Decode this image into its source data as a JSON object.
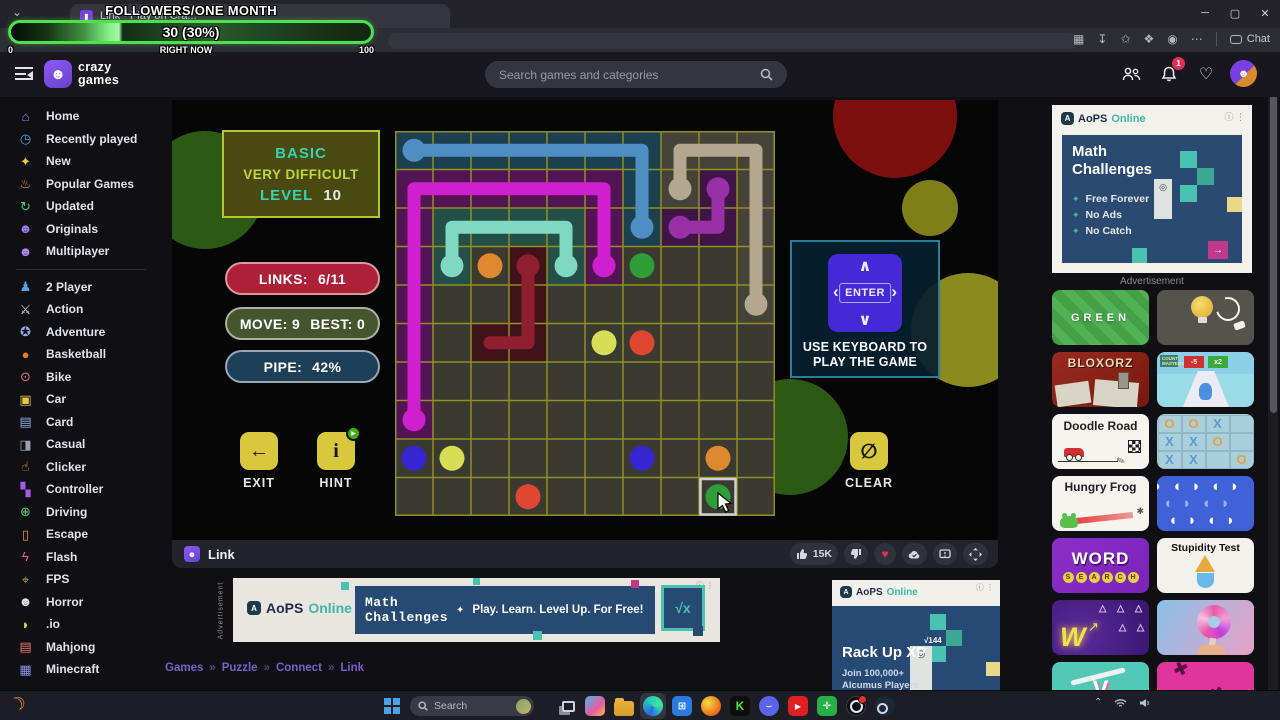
{
  "overlay": {
    "title": "FOLLOWERS/ONE MONTH",
    "value_label": "30 (30%)",
    "min_label": "0",
    "now_label": "RIGHT NOW",
    "max_label": "100",
    "percent": 30
  },
  "browser": {
    "tab_title": "Link · Play on Cra...",
    "chat_label": "Chat"
  },
  "header": {
    "wordmark1": "crazy",
    "wordmark2": "games",
    "search_placeholder": "Search games and categories",
    "notification_count": "1"
  },
  "sidebar": {
    "items": [
      {
        "label": "Home",
        "icon": "home-icon",
        "glyph": "⌂",
        "color": "#9b7bf0"
      },
      {
        "label": "Recently played",
        "icon": "clock-icon",
        "glyph": "◷",
        "color": "#5aa2e8"
      },
      {
        "label": "New",
        "icon": "sparkles-icon",
        "glyph": "✦",
        "color": "#e8c84a"
      },
      {
        "label": "Popular Games",
        "icon": "flame-icon",
        "glyph": "♨",
        "color": "#f08a3c"
      },
      {
        "label": "Updated",
        "icon": "refresh-icon",
        "glyph": "↻",
        "color": "#57c96b"
      },
      {
        "label": "Originals",
        "icon": "ghost-icon",
        "glyph": "☻",
        "color": "#9b7bf0"
      },
      {
        "label": "Multiplayer",
        "icon": "people-icon",
        "glyph": "☻",
        "color": "#b58af0",
        "divider_after": true
      },
      {
        "label": "2 Player",
        "icon": "two-player-icon",
        "glyph": "♟",
        "color": "#5aa2e8"
      },
      {
        "label": "Action",
        "icon": "sword-icon",
        "glyph": "⚔",
        "color": "#d8d8e0"
      },
      {
        "label": "Adventure",
        "icon": "compass-icon",
        "glyph": "✪",
        "color": "#9aa8e8"
      },
      {
        "label": "Basketball",
        "icon": "basketball-icon",
        "glyph": "●",
        "color": "#e8782c"
      },
      {
        "label": "Bike",
        "icon": "bike-icon",
        "glyph": "⊙",
        "color": "#e86a8a"
      },
      {
        "label": "Car",
        "icon": "car-icon",
        "glyph": "▣",
        "color": "#e8c84a"
      },
      {
        "label": "Card",
        "icon": "card-icon",
        "glyph": "▤",
        "color": "#8ab4e8"
      },
      {
        "label": "Casual",
        "icon": "joystick-icon",
        "glyph": "◨",
        "color": "#9aa0b0"
      },
      {
        "label": "Clicker",
        "icon": "pointer-icon",
        "glyph": "☝",
        "color": "#e8a83c"
      },
      {
        "label": "Controller",
        "icon": "gamepad-icon",
        "glyph": "▚",
        "color": "#a85ae8"
      },
      {
        "label": "Driving",
        "icon": "steering-wheel-icon",
        "glyph": "⊕",
        "color": "#57c96b"
      },
      {
        "label": "Escape",
        "icon": "door-icon",
        "glyph": "▯",
        "color": "#e8953c"
      },
      {
        "label": "Flash",
        "icon": "lightning-icon",
        "glyph": "ϟ",
        "color": "#e85aa0"
      },
      {
        "label": "FPS",
        "icon": "crosshair-icon",
        "glyph": "⌖",
        "color": "#c9a05a"
      },
      {
        "label": "Horror",
        "icon": "ghost-icon",
        "glyph": "☻",
        "color": "#e8e8f0"
      },
      {
        "label": ".io",
        "icon": "pacman-icon",
        "glyph": "◗",
        "color": "#e8d84a"
      },
      {
        "label": "Mahjong",
        "icon": "tile-icon",
        "glyph": "▤",
        "color": "#e87a6a"
      },
      {
        "label": "Minecraft",
        "icon": "block-icon",
        "glyph": "▦",
        "color": "#8a94e8"
      }
    ]
  },
  "game": {
    "level_box": {
      "line1": "BASIC",
      "line2": "VERY DIFFICULT",
      "level_label": "LEVEL",
      "level_value": "10"
    },
    "stats": {
      "links_label": "LINKS:",
      "links_value": "6/11",
      "move_label": "MOVE: 9",
      "best_label": "BEST: 0",
      "pipe_label": "PIPE:",
      "pipe_value": "42%"
    },
    "buttons": {
      "exit": "EXIT",
      "hint": "HINT",
      "clear": "CLEAR"
    },
    "keyboard": {
      "key_label": "ENTER",
      "caption1": "USE KEYBOARD TO",
      "caption2": "PLAY THE GAME"
    },
    "grid": {
      "cols": 10,
      "rows": 10,
      "line_color": "#8f8f22",
      "cell_bg": "#3a3a31",
      "pipes": [
        {
          "name": "blue",
          "color": "#4e8ec2",
          "tint": "#1d4050",
          "path": [
            [
              0,
              0
            ],
            [
              6,
              0
            ],
            [
              6,
              2
            ]
          ],
          "endpoints": [
            [
              0,
              0
            ],
            [
              6,
              2
            ]
          ]
        },
        {
          "name": "tan",
          "color": "#b3a88f",
          "tint": "#45423a",
          "path": [
            [
              7,
              1
            ],
            [
              7,
              0
            ],
            [
              9,
              0
            ],
            [
              9,
              4
            ]
          ],
          "endpoints": [
            [
              7,
              1
            ],
            [
              9,
              4
            ]
          ]
        },
        {
          "name": "magenta",
          "color": "#cf1fcf",
          "tint": "#521452",
          "path": [
            [
              5,
              3
            ],
            [
              5,
              1
            ],
            [
              0,
              1
            ],
            [
              0,
              7
            ]
          ],
          "endpoints": [
            [
              5,
              3
            ],
            [
              0,
              7
            ]
          ]
        },
        {
          "name": "teal",
          "color": "#7fd8c0",
          "tint": "#234f46",
          "path": [
            [
              1,
              3
            ],
            [
              1,
              2
            ],
            [
              4,
              2
            ],
            [
              4,
              3
            ]
          ],
          "endpoints": [
            [
              1,
              3
            ],
            [
              4,
              3
            ]
          ]
        },
        {
          "name": "purple",
          "color": "#9a30a8",
          "tint": "#3f1545",
          "path": [
            [
              8,
              1
            ],
            [
              8,
              2
            ],
            [
              7,
              2
            ]
          ],
          "endpoints": [
            [
              8,
              1
            ],
            [
              7,
              2
            ]
          ]
        },
        {
          "name": "dark-red",
          "color": "#8f1f2f",
          "tint": "#401219",
          "path": [
            [
              3,
              3
            ],
            [
              3,
              5
            ],
            [
              2,
              5
            ]
          ],
          "endpoints": [
            [
              3,
              3
            ]
          ]
        }
      ],
      "dots": [
        {
          "color": "#de8830",
          "cell": [
            2,
            3
          ]
        },
        {
          "color": "#2f9e38",
          "cell": [
            6,
            3
          ]
        },
        {
          "color": "#d6de55",
          "cell": [
            5,
            5
          ]
        },
        {
          "color": "#de4830",
          "cell": [
            6,
            5
          ]
        },
        {
          "color": "#3526cf",
          "cell": [
            0,
            8
          ]
        },
        {
          "color": "#d6de55",
          "cell": [
            1,
            8
          ]
        },
        {
          "color": "#3526cf",
          "cell": [
            6,
            8
          ]
        },
        {
          "color": "#de8830",
          "cell": [
            8,
            8
          ]
        },
        {
          "color": "#de4830",
          "cell": [
            3,
            9
          ]
        },
        {
          "color": "#2f9e38",
          "cell": [
            8,
            9
          ]
        }
      ],
      "selected_cell": [
        8,
        9
      ]
    }
  },
  "player_bar": {
    "title": "Link",
    "likes": "15K"
  },
  "ads": {
    "top_right": {
      "brand_a": "AoPS",
      "brand_b": "Online",
      "heading1": "Math",
      "heading2": "Challenges",
      "bullets": [
        "Free Forever",
        "No Ads",
        "No Catch"
      ],
      "caption": "Advertisement"
    },
    "banner": {
      "side_label": "Advertisement",
      "brand_a": "AoPS",
      "brand_b": "Online",
      "heading1": "Math",
      "heading2": "Challenges",
      "tagline": "Play. Learn. Level Up. For Free!",
      "formula": "√x"
    },
    "bottom_right": {
      "brand_a": "AoPS",
      "brand_b": "Online",
      "heading": "Rack Up XP",
      "sub1": "Join 100,000+",
      "sub2": "Alcumus Players",
      "formula": "√144"
    }
  },
  "thumbnails": [
    {
      "kind": "green",
      "name": "thumb-green",
      "title": "GREEN"
    },
    {
      "kind": "bulb",
      "name": "thumb-bulb-plug"
    },
    {
      "kind": "blox",
      "name": "thumb-bloxorz",
      "title": "BLOXORZ"
    },
    {
      "kind": "count",
      "name": "thumb-count-runner",
      "badge_left": "-5",
      "badge_right": "x2",
      "flag": "COUNT MASTERS"
    },
    {
      "kind": "doodle",
      "name": "thumb-doodle-road",
      "title": "Doodle Road"
    },
    {
      "kind": "ttt",
      "name": "thumb-tic-tac-toe"
    },
    {
      "kind": "frog",
      "name": "thumb-hungry-frog",
      "title": "Hungry Frog"
    },
    {
      "kind": "bluepac",
      "name": "thumb-blue-shapes"
    },
    {
      "kind": "ws",
      "name": "thumb-word-search",
      "title_top": "WORD",
      "title_bottom": "SEARCH"
    },
    {
      "kind": "stup",
      "name": "thumb-stupidity-test",
      "title": "Stupidity Test"
    },
    {
      "kind": "neon",
      "name": "thumb-neon-wave"
    },
    {
      "kind": "donut",
      "name": "thumb-donut-twist"
    },
    {
      "kind": "candyv",
      "name": "thumb-candy"
    },
    {
      "kind": "pink",
      "name": "thumb-pink-shapes"
    }
  ],
  "breadcrumb": {
    "items": [
      "Games",
      "Puzzle",
      "Connect",
      "Link"
    ],
    "separator": "»"
  },
  "taskbar": {
    "search_placeholder": "Search",
    "apps": [
      "task-view",
      "phone-link",
      "folder",
      "edge",
      "store",
      "firefox",
      "kick",
      "discord",
      "youtube",
      "sharex",
      "obs",
      "steam"
    ]
  }
}
